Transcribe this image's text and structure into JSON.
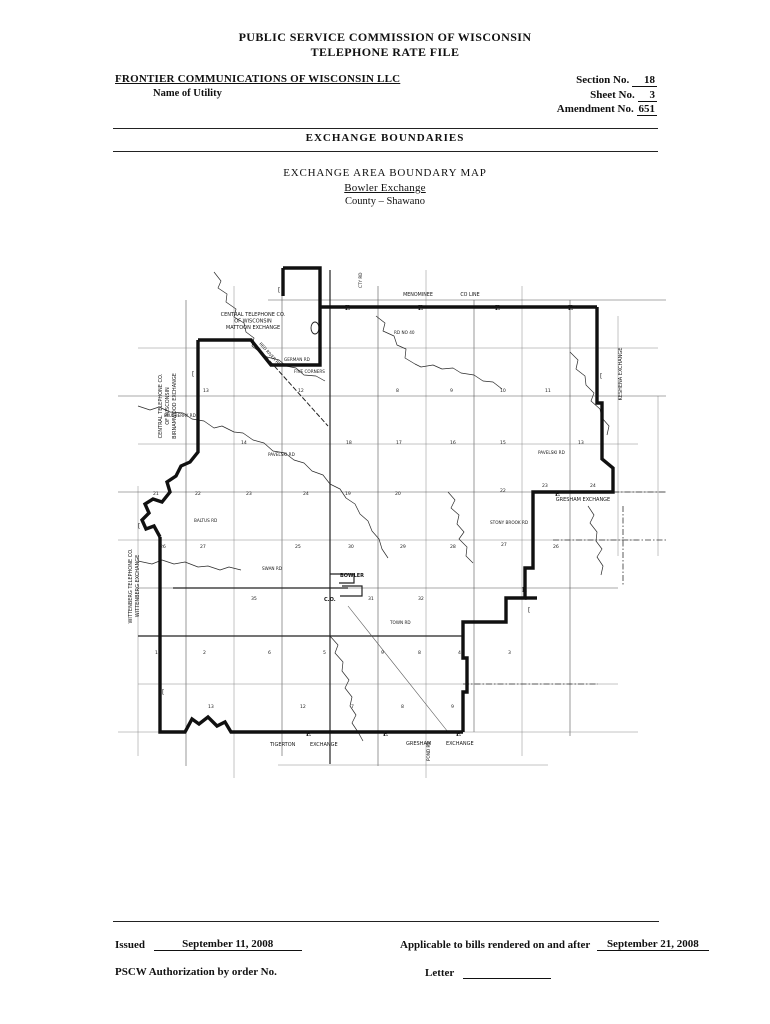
{
  "header": {
    "title_line1": "PUBLIC SERVICE COMMISSION OF WISCONSIN",
    "title_line2": "TELEPHONE RATE FILE",
    "utility_name": "FRONTIER COMMUNICATIONS OF WISCONSIN LLC",
    "utility_label": "Name of Utility",
    "section_label": "Section No.",
    "section_value": "18",
    "sheet_label": "Sheet No.",
    "sheet_value": "3",
    "amendment_label": "Amendment No.",
    "amendment_value": "651",
    "heading": "EXCHANGE BOUNDARIES",
    "map_title": "EXCHANGE AREA BOUNDARY MAP",
    "map_subtitle": "Bowler Exchange",
    "map_county": "County – Shawano"
  },
  "footer": {
    "issued_label": "Issued",
    "issued_date": "September 11, 2008",
    "applicable_label": "Applicable to bills rendered on and after",
    "applicable_date": "September 21, 2008",
    "authorization_label": "PSCW Authorization by order No.",
    "letter_label": "Letter"
  },
  "map": {
    "exchange_labels": [
      {
        "text": "CENTRAL TELEPHONE CO.",
        "x": 135,
        "y": 60,
        "size": 5,
        "anchor": "middle",
        "name": "mattoon-exchange-label"
      },
      {
        "text": "OF WISCONSIN",
        "x": 135,
        "y": 66.5,
        "size": 5,
        "anchor": "middle",
        "name": "mattoon-exchange-label"
      },
      {
        "text": "MATTOON EXCHANGE",
        "x": 135,
        "y": 73,
        "size": 5,
        "anchor": "middle",
        "name": "mattoon-exchange-label"
      },
      {
        "text": "CENTRAL TELEPHONE CO.",
        "x": 44,
        "y": 150,
        "size": 5,
        "rotate": -90,
        "anchor": "middle",
        "name": "birnamwood-exchange-label"
      },
      {
        "text": "OF WISCONSIN",
        "x": 51,
        "y": 150,
        "size": 5,
        "rotate": -90,
        "anchor": "middle",
        "name": "birnamwood-exchange-label"
      },
      {
        "text": "BIRNAMWOOD EXCHANGE",
        "x": 58,
        "y": 150,
        "size": 5,
        "rotate": -90,
        "anchor": "middle",
        "name": "birnamwood-exchange-label"
      },
      {
        "text": "WITTENBERG TELEPHONE CO.",
        "x": 14,
        "y": 330,
        "size": 5,
        "rotate": -90,
        "anchor": "middle",
        "name": "wittenberg-exchange-label"
      },
      {
        "text": "WITTENBERG EXCHANGE",
        "x": 21,
        "y": 330,
        "size": 5,
        "rotate": -90,
        "anchor": "middle",
        "name": "wittenberg-exchange-label"
      },
      {
        "text": "MENOMINEE",
        "x": 300,
        "y": 40,
        "size": 4.8,
        "anchor": "middle",
        "name": "county-line-label"
      },
      {
        "text": "CO LINE",
        "x": 352,
        "y": 40,
        "size": 4.8,
        "anchor": "middle",
        "name": "county-line-label"
      },
      {
        "text": "KESHENA EXCHANGE",
        "x": 504,
        "y": 118,
        "size": 5,
        "rotate": -90,
        "anchor": "middle",
        "name": "keshena-exchange-label"
      },
      {
        "text": "GRESHAM EXCHANGE",
        "x": 465,
        "y": 245,
        "size": 5,
        "anchor": "middle",
        "name": "gresham-exchange-label"
      },
      {
        "text": "TIGERTON",
        "x": 152,
        "y": 490,
        "size": 5,
        "name": "tigerton-exchange-label"
      },
      {
        "text": "EXCHANGE",
        "x": 192,
        "y": 490,
        "size": 5,
        "name": "tigerton-exchange-label"
      },
      {
        "text": "GRESHAM",
        "x": 288,
        "y": 489,
        "size": 5,
        "name": "gresham-exchange-bottom-label"
      },
      {
        "text": "EXCHANGE",
        "x": 328,
        "y": 489,
        "size": 5,
        "name": "gresham-exchange-bottom-label"
      }
    ],
    "place_labels": [
      {
        "text": "BOWLER",
        "x": 222,
        "y": 321,
        "size": 5,
        "weight": "bold",
        "name": "bowler-town-label"
      },
      {
        "text": "C.O.",
        "x": 206,
        "y": 345,
        "size": 5,
        "weight": "bold",
        "name": "central-office-label"
      }
    ],
    "road_labels": [
      {
        "text": "RED RIVER RD",
        "x": 141,
        "y": 88,
        "size": 4.2,
        "rotate": 48
      },
      {
        "text": "GERMAN RD",
        "x": 166,
        "y": 105,
        "size": 4.2
      },
      {
        "text": "FIVE CORNERS",
        "x": 176,
        "y": 117,
        "size": 4.2
      },
      {
        "text": "RD NO 40",
        "x": 276,
        "y": 78,
        "size": 4.2
      },
      {
        "text": "BLUEBERRY RD",
        "x": 46,
        "y": 161,
        "size": 4.2
      },
      {
        "text": "PAVELSKI RD",
        "x": 150,
        "y": 200,
        "size": 4.2
      },
      {
        "text": "PAVELSKI RD",
        "x": 420,
        "y": 198,
        "size": 4.2
      },
      {
        "text": "BALTUS RD",
        "x": 76,
        "y": 266,
        "size": 4.2
      },
      {
        "text": "STONY BROOK RD",
        "x": 372,
        "y": 268,
        "size": 4.2
      },
      {
        "text": "SWAN RD",
        "x": 144,
        "y": 314,
        "size": 4.2
      },
      {
        "text": "TOWN RD",
        "x": 272,
        "y": 368,
        "size": 4.2
      },
      {
        "text": "CTY RD",
        "x": 244,
        "y": 32,
        "size": 4.2,
        "rotate": -90
      },
      {
        "text": "POND RD",
        "x": 312,
        "y": 505,
        "size": 4.2,
        "rotate": -90
      }
    ],
    "section_numbers": [
      {
        "n": "13",
        "x": 85,
        "y": 136
      },
      {
        "n": "12",
        "x": 180,
        "y": 136
      },
      {
        "n": "8",
        "x": 278,
        "y": 136
      },
      {
        "n": "9",
        "x": 332,
        "y": 136
      },
      {
        "n": "10",
        "x": 382,
        "y": 136
      },
      {
        "n": "11",
        "x": 427,
        "y": 136
      },
      {
        "n": "14",
        "x": 123,
        "y": 188
      },
      {
        "n": "18",
        "x": 228,
        "y": 188
      },
      {
        "n": "17",
        "x": 278,
        "y": 188
      },
      {
        "n": "16",
        "x": 332,
        "y": 188
      },
      {
        "n": "15",
        "x": 382,
        "y": 188
      },
      {
        "n": "13",
        "x": 460,
        "y": 188
      },
      {
        "n": "21",
        "x": 35,
        "y": 239
      },
      {
        "n": "22",
        "x": 77,
        "y": 239
      },
      {
        "n": "23",
        "x": 128,
        "y": 239
      },
      {
        "n": "24",
        "x": 185,
        "y": 239
      },
      {
        "n": "19",
        "x": 227,
        "y": 239
      },
      {
        "n": "20",
        "x": 277,
        "y": 239
      },
      {
        "n": "22",
        "x": 382,
        "y": 236
      },
      {
        "n": "23",
        "x": 424,
        "y": 231
      },
      {
        "n": "24",
        "x": 472,
        "y": 231
      },
      {
        "n": "26",
        "x": 42,
        "y": 292
      },
      {
        "n": "27",
        "x": 82,
        "y": 292
      },
      {
        "n": "25",
        "x": 177,
        "y": 292
      },
      {
        "n": "30",
        "x": 230,
        "y": 292
      },
      {
        "n": "29",
        "x": 282,
        "y": 292
      },
      {
        "n": "28",
        "x": 332,
        "y": 292
      },
      {
        "n": "27",
        "x": 383,
        "y": 290
      },
      {
        "n": "26",
        "x": 435,
        "y": 292
      },
      {
        "n": "35",
        "x": 133,
        "y": 344
      },
      {
        "n": "31",
        "x": 250,
        "y": 344
      },
      {
        "n": "32",
        "x": 300,
        "y": 344
      },
      {
        "n": "1",
        "x": 37,
        "y": 398
      },
      {
        "n": "2",
        "x": 85,
        "y": 398
      },
      {
        "n": "6",
        "x": 150,
        "y": 398
      },
      {
        "n": "5",
        "x": 205,
        "y": 398
      },
      {
        "n": "9",
        "x": 263,
        "y": 398
      },
      {
        "n": "8",
        "x": 300,
        "y": 398
      },
      {
        "n": "4",
        "x": 340,
        "y": 398
      },
      {
        "n": "3",
        "x": 390,
        "y": 398
      },
      {
        "n": "13",
        "x": 90,
        "y": 452
      },
      {
        "n": "12",
        "x": 182,
        "y": 452
      },
      {
        "n": "7",
        "x": 233,
        "y": 452
      },
      {
        "n": "8",
        "x": 283,
        "y": 452
      },
      {
        "n": "9",
        "x": 333,
        "y": 452
      }
    ],
    "boundary_markers": [
      {
        "x": 227,
        "y": 54
      },
      {
        "x": 300,
        "y": 54
      },
      {
        "x": 377,
        "y": 54
      },
      {
        "x": 450,
        "y": 54
      },
      {
        "x": 437,
        "y": 240
      },
      {
        "x": 404,
        "y": 336
      },
      {
        "x": 188,
        "y": 480
      },
      {
        "x": 265,
        "y": 480
      },
      {
        "x": 338,
        "y": 480
      }
    ],
    "bracket_markers": [
      {
        "x": 160,
        "y": 36
      },
      {
        "x": 74,
        "y": 120
      },
      {
        "x": 20,
        "y": 272
      },
      {
        "x": 44,
        "y": 438
      },
      {
        "x": 482,
        "y": 122
      },
      {
        "x": 410,
        "y": 356
      }
    ]
  }
}
